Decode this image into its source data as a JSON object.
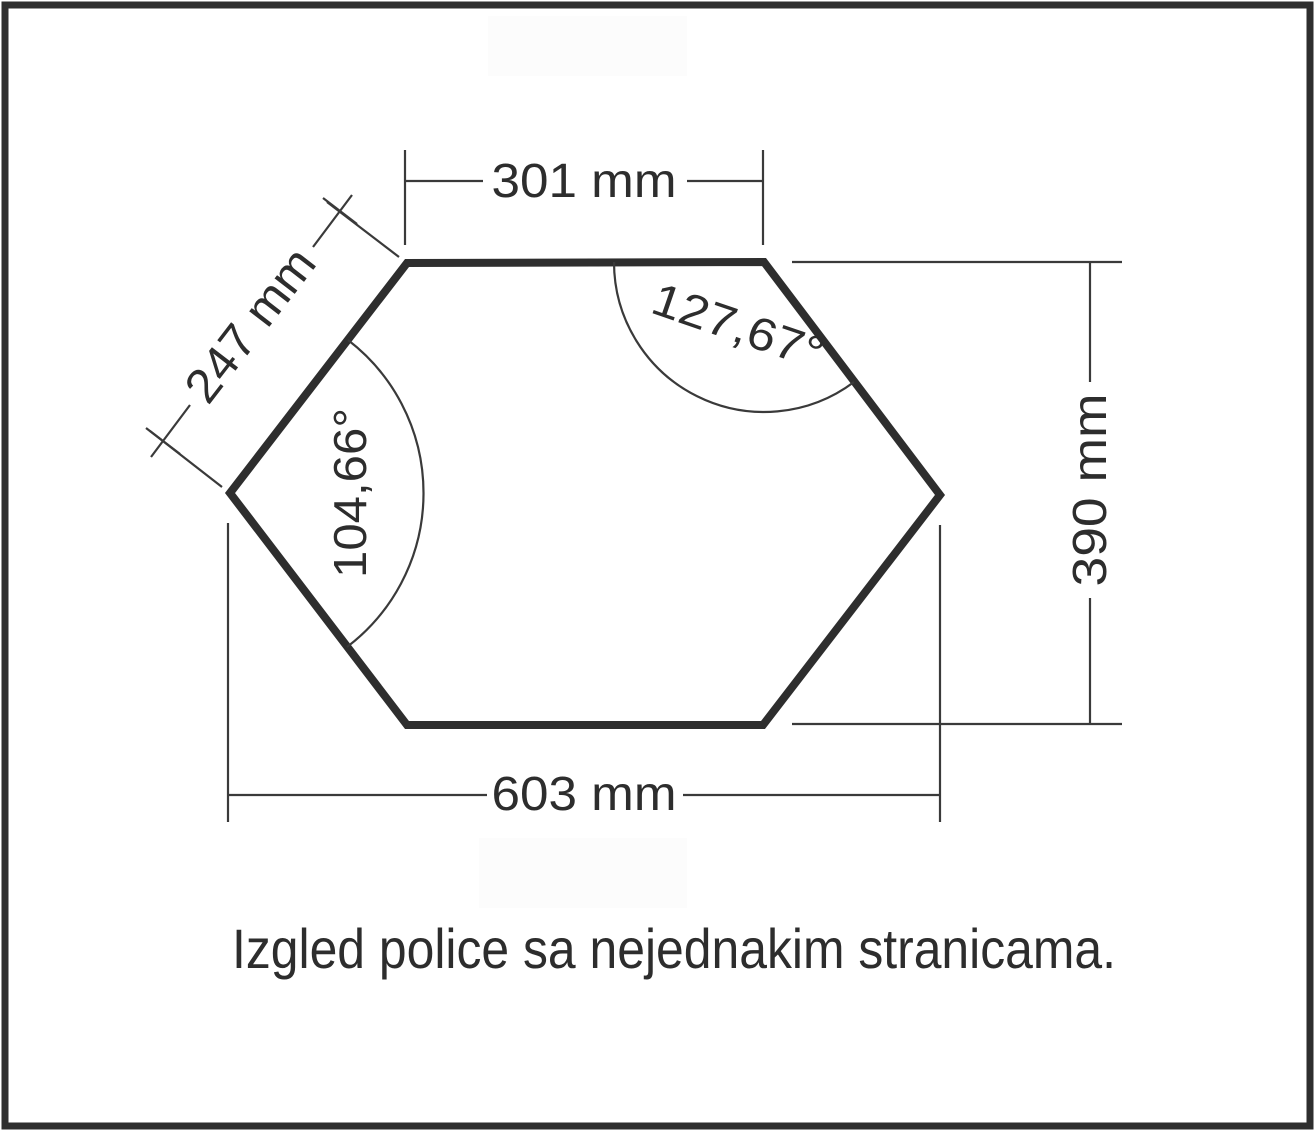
{
  "diagram": {
    "caption": "Izgled police sa nejednakim stranicama.",
    "labels": {
      "top_width": "301 mm",
      "slant_side": "247 mm",
      "bottom_width": "603 mm",
      "height": "390 mm"
    },
    "angles": {
      "top_right": "127,67°",
      "left": "104,66°"
    },
    "colors": {
      "outline": "#2e2e2e",
      "thin_line": "#3a3a3a",
      "text": "#2d2d2d",
      "background": "#ffffff",
      "watermark": "#fcfcfc",
      "page_border": "#2e2e2e"
    }
  }
}
